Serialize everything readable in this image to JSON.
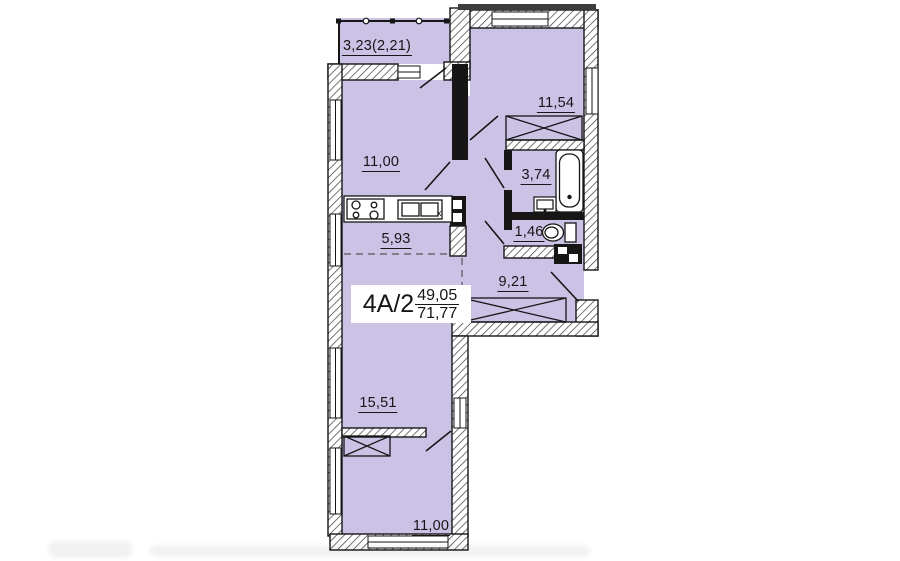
{
  "plan": {
    "apartment_label": {
      "type": "4А/2",
      "living_area": "49,05",
      "total_area": "71,77"
    },
    "rooms": {
      "balcony": {
        "area": "3,23(2,21)"
      },
      "bedroom_top": {
        "area": "11,54"
      },
      "room_left": {
        "area": "11,00"
      },
      "kitchen": {
        "area": "5,93",
        "counter_mark": "x"
      },
      "bathroom": {
        "area": "3,74"
      },
      "wc": {
        "area": "1,46"
      },
      "hallway": {
        "area": "9,21"
      },
      "living_room": {
        "area": "15,51"
      },
      "bedroom_bottom": {
        "area": "11,00"
      }
    },
    "colors": {
      "room_fill": "#cbc2e6",
      "wall": "#161616",
      "background": "#ffffff"
    }
  }
}
